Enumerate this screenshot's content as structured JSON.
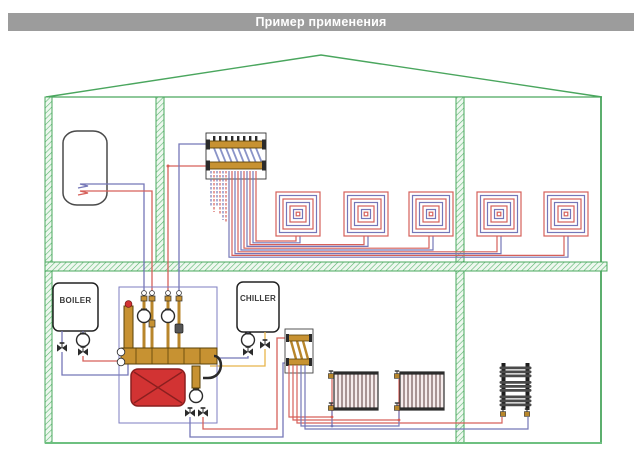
{
  "title": "Пример применения",
  "equipment": {
    "boiler_label": "BOILER",
    "chiller_label": "CHILLER"
  },
  "components": [
    "water-heater-tank",
    "floor-heating-manifold",
    "floor-heating-loop-spirals",
    "pump-mixing-group",
    "expansion-tank",
    "radiator-manifold",
    "panel-radiator",
    "towel-rail-radiator",
    "circulation-pump",
    "shut-off-valve"
  ],
  "palette": {
    "titlebar_gray": "#9c9c9c",
    "structure_green": "#4aa65e",
    "floor_hatch_green": "#5cb570",
    "hot_pipe_red": "#d6605a",
    "return_pipe_blue": "#7577b8",
    "chiller_pipe_yellow": "#e8b54a",
    "brass": "#c79232",
    "expansion_tank_red": "#d23333"
  }
}
